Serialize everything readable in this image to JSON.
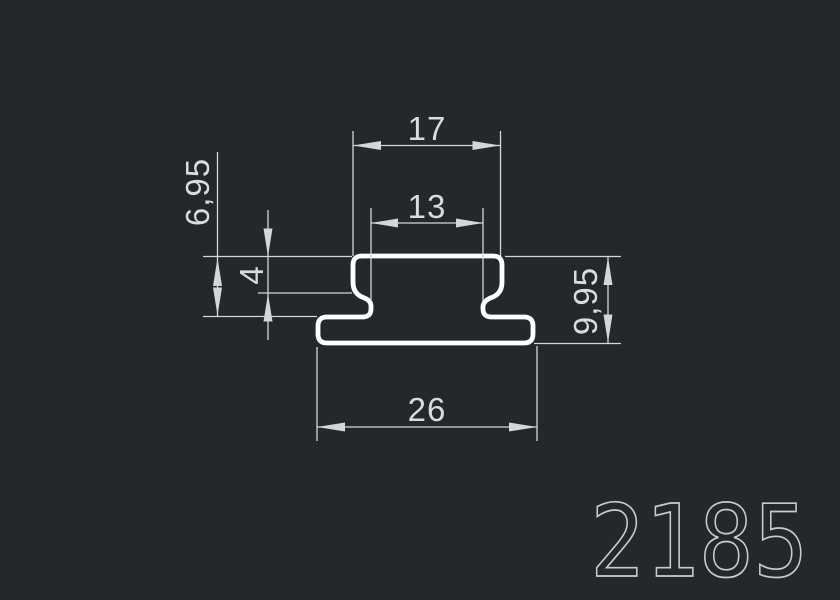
{
  "drawing": {
    "part_number": "2185",
    "dimensions": {
      "cap_width": "17",
      "neck_width": "13",
      "base_width": "26",
      "cap_thickness": "4",
      "upper_height": "6,95",
      "total_height": "9,95"
    },
    "colors": {
      "background": "#24282c",
      "geometry_stroke": "#ffffff",
      "dimension_stroke": "#d4d6d8",
      "part_number_stroke": "#c9ccce"
    }
  }
}
